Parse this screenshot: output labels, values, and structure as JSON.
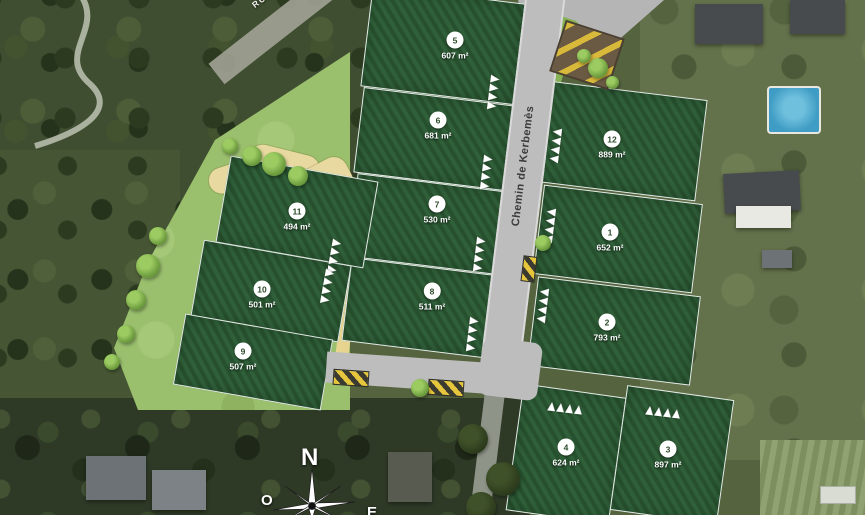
{
  "map": {
    "area_unit": "m²",
    "roads": {
      "main_label": "Chemin de Kerbemès",
      "top_left_label": "RUE DU MOULIN"
    },
    "compass": {
      "north": "N",
      "west": "O",
      "east": "E"
    },
    "lots": [
      {
        "num": "5",
        "area": "607",
        "x": 366,
        "y": -6,
        "w": 154,
        "h": 102,
        "angle": 7,
        "cx": 455,
        "cy": 42
      },
      {
        "num": "6",
        "area": "681",
        "x": 358,
        "y": 96,
        "w": 152,
        "h": 86,
        "angle": 7,
        "cx": 438,
        "cy": 122
      },
      {
        "num": "7",
        "area": "530",
        "x": 352,
        "y": 182,
        "w": 150,
        "h": 84,
        "angle": 7,
        "cx": 437,
        "cy": 206
      },
      {
        "num": "8",
        "area": "511",
        "x": 346,
        "y": 266,
        "w": 148,
        "h": 84,
        "angle": 7,
        "cx": 432,
        "cy": 293
      },
      {
        "num": "11",
        "area": "494",
        "x": 222,
        "y": 168,
        "w": 150,
        "h": 88,
        "angle": 10,
        "cx": 297,
        "cy": 213
      },
      {
        "num": "10",
        "area": "501",
        "x": 196,
        "y": 252,
        "w": 150,
        "h": 78,
        "angle": 10,
        "cx": 262,
        "cy": 291
      },
      {
        "num": "9",
        "area": "507",
        "x": 178,
        "y": 326,
        "w": 150,
        "h": 72,
        "angle": 10,
        "cx": 243,
        "cy": 353
      },
      {
        "num": "12",
        "area": "889",
        "x": 542,
        "y": 90,
        "w": 160,
        "h": 102,
        "angle": 7,
        "cx": 612,
        "cy": 141
      },
      {
        "num": "1",
        "area": "652",
        "x": 538,
        "y": 194,
        "w": 160,
        "h": 90,
        "angle": 7,
        "cx": 610,
        "cy": 234
      },
      {
        "num": "2",
        "area": "793",
        "x": 532,
        "y": 286,
        "w": 164,
        "h": 90,
        "angle": 7,
        "cx": 607,
        "cy": 324
      },
      {
        "num": "4",
        "area": "624",
        "x": 514,
        "y": 390,
        "w": 104,
        "h": 128,
        "angle": 8,
        "cx": 566,
        "cy": 449
      },
      {
        "num": "3",
        "area": "897",
        "x": 618,
        "y": 392,
        "w": 108,
        "h": 126,
        "angle": 8,
        "cx": 668,
        "cy": 451
      }
    ],
    "frontage_markers": [
      {
        "x": 489,
        "y": 74,
        "a": 7
      },
      {
        "x": 482,
        "y": 154,
        "a": 7
      },
      {
        "x": 475,
        "y": 236,
        "a": 7
      },
      {
        "x": 468,
        "y": 316,
        "a": 7
      },
      {
        "x": 551,
        "y": 128,
        "a": 187
      },
      {
        "x": 545,
        "y": 208,
        "a": 187
      },
      {
        "x": 538,
        "y": 288,
        "a": 187
      },
      {
        "x": 330,
        "y": 238,
        "a": 10
      },
      {
        "x": 323,
        "y": 268,
        "a": 10
      },
      {
        "x": 560,
        "y": 390,
        "a": -83
      },
      {
        "x": 658,
        "y": 394,
        "a": -83
      }
    ],
    "trees": [
      {
        "x": 148,
        "y": 266,
        "d": 24
      },
      {
        "x": 136,
        "y": 300,
        "d": 20
      },
      {
        "x": 158,
        "y": 236,
        "d": 18
      },
      {
        "x": 126,
        "y": 334,
        "d": 18
      },
      {
        "x": 112,
        "y": 362,
        "d": 16
      },
      {
        "x": 252,
        "y": 156,
        "d": 20
      },
      {
        "x": 274,
        "y": 164,
        "d": 24
      },
      {
        "x": 298,
        "y": 176,
        "d": 20
      },
      {
        "x": 230,
        "y": 146,
        "d": 16
      },
      {
        "x": 543,
        "y": 243,
        "d": 16
      },
      {
        "x": 420,
        "y": 388,
        "d": 18
      },
      {
        "x": 598,
        "y": 68,
        "d": 20
      },
      {
        "x": 584,
        "y": 56,
        "d": 14
      },
      {
        "x": 612,
        "y": 82,
        "d": 13
      }
    ],
    "crossings": [
      {
        "x": 333,
        "y": 370,
        "w": 36,
        "h": 16,
        "a": 4
      },
      {
        "x": 428,
        "y": 380,
        "w": 36,
        "h": 16,
        "a": 4
      },
      {
        "x": 522,
        "y": 256,
        "w": 14,
        "h": 26,
        "a": 7
      }
    ]
  },
  "colors": {
    "lot_green": "#2f5c33",
    "meadow_green": "#9abf6d",
    "verge_green": "#7fb24a",
    "road_gray": "#bdbdbd",
    "marking_yellow": "#e5c63c"
  }
}
